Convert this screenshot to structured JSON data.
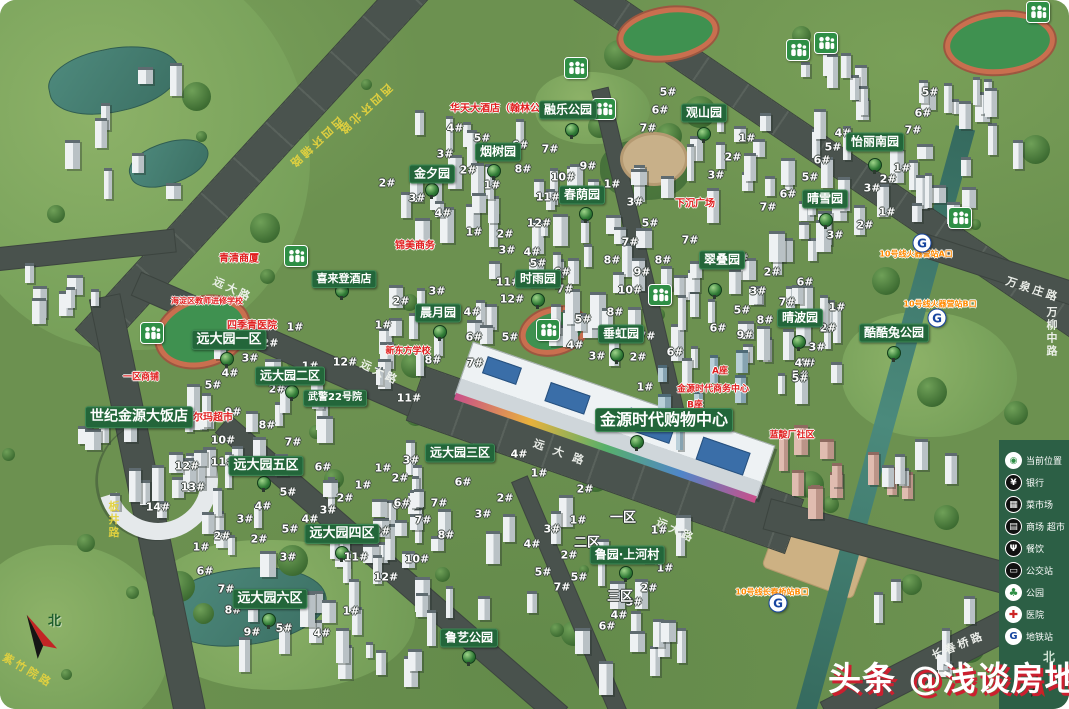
{
  "watermark": {
    "text": "头条 @浅谈房地产"
  },
  "compass": {
    "north": "北"
  },
  "legend": {
    "north": "北",
    "panel_color": "#2c5f45",
    "items": [
      {
        "label": "当前位置",
        "icon": "loc",
        "glyph": "◉"
      },
      {
        "label": "银行",
        "icon": "bank",
        "glyph": "¥"
      },
      {
        "label": "菜市场",
        "icon": "market",
        "glyph": "▦"
      },
      {
        "label": "商场 超市",
        "icon": "mall",
        "glyph": "▤"
      },
      {
        "label": "餐饮",
        "icon": "food",
        "glyph": "Ψ"
      },
      {
        "label": "公交站",
        "icon": "bus",
        "glyph": "▭"
      },
      {
        "label": "公园",
        "icon": "park",
        "glyph": "♣"
      },
      {
        "label": "医院",
        "icon": "hospital",
        "glyph": "✚"
      },
      {
        "label": "地铁站",
        "icon": "subway",
        "glyph": "G"
      }
    ]
  },
  "colors": {
    "label_green": "#23663a",
    "legend_green": "#2c5f45",
    "grass": "#6c9150",
    "road": "#49524d",
    "water": "#3f7a6e",
    "red_text": "#e01f1f",
    "orange_text": "#ff8a00"
  },
  "map": {
    "place_labels": [
      {
        "t": "融乐公园",
        "x": 568,
        "y": 110,
        "s": 12
      },
      {
        "t": "观山园",
        "x": 704,
        "y": 113,
        "s": 12
      },
      {
        "t": "怡丽南园",
        "x": 875,
        "y": 142,
        "s": 12
      },
      {
        "t": "烟树园",
        "x": 498,
        "y": 152,
        "s": 12
      },
      {
        "t": "金夕园",
        "x": 432,
        "y": 174,
        "s": 12
      },
      {
        "t": "春荫园",
        "x": 582,
        "y": 195,
        "s": 12
      },
      {
        "t": "晴雪园",
        "x": 825,
        "y": 199,
        "s": 12
      },
      {
        "t": "翠叠园",
        "x": 722,
        "y": 260,
        "s": 12
      },
      {
        "t": "喜来登酒店",
        "x": 344,
        "y": 279,
        "s": 11
      },
      {
        "t": "时雨园",
        "x": 538,
        "y": 279,
        "s": 12
      },
      {
        "t": "晨月园",
        "x": 438,
        "y": 313,
        "s": 12
      },
      {
        "t": "晴波园",
        "x": 800,
        "y": 318,
        "s": 12
      },
      {
        "t": "酷酷兔公园",
        "x": 894,
        "y": 333,
        "s": 12
      },
      {
        "t": "垂虹园",
        "x": 621,
        "y": 334,
        "s": 12
      },
      {
        "t": "远大园一区",
        "x": 229,
        "y": 340,
        "s": 13
      },
      {
        "t": "远大园二区",
        "x": 290,
        "y": 376,
        "s": 12
      },
      {
        "t": "武警22号院",
        "x": 335,
        "y": 398,
        "s": 10
      },
      {
        "t": "世纪金源大饭店",
        "x": 139,
        "y": 417,
        "s": 14
      },
      {
        "t": "金源时代购物中心",
        "x": 664,
        "y": 420,
        "s": 16
      },
      {
        "t": "远大园三区",
        "x": 460,
        "y": 453,
        "s": 12
      },
      {
        "t": "远大园五区",
        "x": 266,
        "y": 466,
        "s": 13
      },
      {
        "t": "远大园四区",
        "x": 342,
        "y": 534,
        "s": 13
      },
      {
        "t": "鲁园·上河村",
        "x": 627,
        "y": 555,
        "s": 12
      },
      {
        "t": "远大园六区",
        "x": 270,
        "y": 599,
        "s": 13
      },
      {
        "t": "鲁艺公园",
        "x": 469,
        "y": 638,
        "s": 12
      }
    ],
    "area_labels": [
      {
        "t": "一区",
        "x": 623,
        "y": 516
      },
      {
        "t": "二区",
        "x": 587,
        "y": 541
      },
      {
        "t": "三区",
        "x": 620,
        "y": 595
      }
    ],
    "red_labels": [
      {
        "t": "华天大酒店（翰林公馆）",
        "x": 505,
        "y": 107,
        "s": 10
      },
      {
        "t": "下沉广场",
        "x": 695,
        "y": 202,
        "s": 10
      },
      {
        "t": "锦美商务",
        "x": 415,
        "y": 244,
        "s": 10
      },
      {
        "t": "青清商厦",
        "x": 239,
        "y": 257,
        "s": 10
      },
      {
        "t": "海淀区教师进修学校",
        "x": 207,
        "y": 301,
        "s": 8
      },
      {
        "t": "四季青医院",
        "x": 252,
        "y": 324,
        "s": 10
      },
      {
        "t": "新东方学校",
        "x": 408,
        "y": 350,
        "s": 9
      },
      {
        "t": "一区商铺",
        "x": 141,
        "y": 376,
        "s": 9
      },
      {
        "t": "沃尔玛超市",
        "x": 208,
        "y": 416,
        "s": 10
      },
      {
        "t": "金源时代商务中心",
        "x": 713,
        "y": 388,
        "s": 9
      },
      {
        "t": "A座",
        "x": 720,
        "y": 370,
        "s": 9
      },
      {
        "t": "B座",
        "x": 695,
        "y": 404,
        "s": 9
      },
      {
        "t": "蓝靛厂社区",
        "x": 792,
        "y": 434,
        "s": 9
      }
    ],
    "subway_entrances": [
      {
        "t": "10号线火器营站A口",
        "x": 916,
        "y": 254
      },
      {
        "t": "10号线火器营站B口",
        "x": 940,
        "y": 304
      },
      {
        "t": "10号线长春桥站B口",
        "x": 772,
        "y": 592
      }
    ],
    "subway_logos": [
      {
        "x": 922,
        "y": 243
      },
      {
        "x": 937,
        "y": 318
      },
      {
        "x": 778,
        "y": 603
      }
    ],
    "road_labels": [
      {
        "t": "西四环北路",
        "x": 365,
        "y": 110,
        "r": 137,
        "c": "#e3d23f"
      },
      {
        "t": "西四环辅路",
        "x": 316,
        "y": 143,
        "r": 137,
        "c": "#e3d23f"
      },
      {
        "t": "远大路",
        "x": 233,
        "y": 289,
        "r": 25,
        "c": "#f2f5f0"
      },
      {
        "t": "远大路",
        "x": 380,
        "y": 372,
        "r": 26,
        "c": "#f2f5f0"
      },
      {
        "t": "远 大 路",
        "x": 560,
        "y": 452,
        "r": 20,
        "c": "#f2f5f0"
      },
      {
        "t": "远大路",
        "x": 676,
        "y": 530,
        "r": 25,
        "c": "#f2f5f0"
      },
      {
        "t": "板井路",
        "x": 113,
        "y": 520,
        "r": 0,
        "c": "#e3d23f",
        "v": true
      },
      {
        "t": "紫竹院路",
        "x": 28,
        "y": 670,
        "r": 30,
        "c": "#e3d23f"
      },
      {
        "t": "长春桥路",
        "x": 958,
        "y": 645,
        "r": -22,
        "c": "#f2f5f0"
      },
      {
        "t": "万泉庄路",
        "x": 1033,
        "y": 289,
        "r": 18,
        "c": "#f2f5f0"
      },
      {
        "t": "万柳中路",
        "x": 1051,
        "y": 332,
        "r": 0,
        "c": "#f2f5f0",
        "v": true
      }
    ],
    "people_icons": [
      {
        "x": 576,
        "y": 68
      },
      {
        "x": 604,
        "y": 109
      },
      {
        "x": 798,
        "y": 50
      },
      {
        "x": 826,
        "y": 43
      },
      {
        "x": 1038,
        "y": 12
      },
      {
        "x": 960,
        "y": 218
      },
      {
        "x": 296,
        "y": 256
      },
      {
        "x": 152,
        "y": 333
      },
      {
        "x": 548,
        "y": 330
      },
      {
        "x": 660,
        "y": 295
      }
    ],
    "tree_markers": [
      {
        "x": 432,
        "y": 190
      },
      {
        "x": 494,
        "y": 171
      },
      {
        "x": 586,
        "y": 214
      },
      {
        "x": 572,
        "y": 130
      },
      {
        "x": 704,
        "y": 134
      },
      {
        "x": 875,
        "y": 165
      },
      {
        "x": 826,
        "y": 220
      },
      {
        "x": 715,
        "y": 290
      },
      {
        "x": 799,
        "y": 342
      },
      {
        "x": 894,
        "y": 353
      },
      {
        "x": 538,
        "y": 300
      },
      {
        "x": 440,
        "y": 332
      },
      {
        "x": 617,
        "y": 355
      },
      {
        "x": 227,
        "y": 359
      },
      {
        "x": 292,
        "y": 392
      },
      {
        "x": 264,
        "y": 483
      },
      {
        "x": 342,
        "y": 553
      },
      {
        "x": 269,
        "y": 620
      },
      {
        "x": 626,
        "y": 573
      },
      {
        "x": 469,
        "y": 657
      },
      {
        "x": 342,
        "y": 291
      },
      {
        "x": 637,
        "y": 442
      }
    ],
    "unit_labels": [
      {
        "t": "5#",
        "x": 668,
        "y": 92
      },
      {
        "t": "6#",
        "x": 660,
        "y": 110
      },
      {
        "t": "7#",
        "x": 648,
        "y": 128
      },
      {
        "t": "1#",
        "x": 747,
        "y": 138
      },
      {
        "t": "2#",
        "x": 733,
        "y": 157
      },
      {
        "t": "3#",
        "x": 716,
        "y": 175
      },
      {
        "t": "5#",
        "x": 930,
        "y": 92
      },
      {
        "t": "6#",
        "x": 923,
        "y": 113
      },
      {
        "t": "7#",
        "x": 913,
        "y": 130
      },
      {
        "t": "4#",
        "x": 843,
        "y": 133
      },
      {
        "t": "5#",
        "x": 833,
        "y": 147
      },
      {
        "t": "6#",
        "x": 822,
        "y": 160
      },
      {
        "t": "1#",
        "x": 902,
        "y": 168
      },
      {
        "t": "2#",
        "x": 888,
        "y": 179
      },
      {
        "t": "3#",
        "x": 872,
        "y": 188
      },
      {
        "t": "5#",
        "x": 810,
        "y": 177
      },
      {
        "t": "6#",
        "x": 788,
        "y": 194
      },
      {
        "t": "7#",
        "x": 768,
        "y": 207
      },
      {
        "t": "1#",
        "x": 887,
        "y": 212
      },
      {
        "t": "2#",
        "x": 865,
        "y": 225
      },
      {
        "t": "3#",
        "x": 835,
        "y": 235
      },
      {
        "t": "4#",
        "x": 455,
        "y": 128
      },
      {
        "t": "5#",
        "x": 482,
        "y": 138
      },
      {
        "t": "3#",
        "x": 445,
        "y": 154
      },
      {
        "t": "6#",
        "x": 520,
        "y": 145
      },
      {
        "t": "7#",
        "x": 550,
        "y": 149
      },
      {
        "t": "2#",
        "x": 468,
        "y": 170
      },
      {
        "t": "1#",
        "x": 492,
        "y": 185
      },
      {
        "t": "8#",
        "x": 523,
        "y": 169
      },
      {
        "t": "9#",
        "x": 588,
        "y": 166
      },
      {
        "t": "10#",
        "x": 563,
        "y": 177
      },
      {
        "t": "11#",
        "x": 548,
        "y": 197
      },
      {
        "t": "12#",
        "x": 539,
        "y": 223
      },
      {
        "t": "1#",
        "x": 612,
        "y": 184
      },
      {
        "t": "3#",
        "x": 635,
        "y": 202
      },
      {
        "t": "5#",
        "x": 650,
        "y": 223
      },
      {
        "t": "2#",
        "x": 387,
        "y": 183
      },
      {
        "t": "3#",
        "x": 417,
        "y": 198
      },
      {
        "t": "4#",
        "x": 443,
        "y": 213
      },
      {
        "t": "1#",
        "x": 474,
        "y": 232
      },
      {
        "t": "2#",
        "x": 505,
        "y": 234
      },
      {
        "t": "7#",
        "x": 690,
        "y": 240
      },
      {
        "t": "8#",
        "x": 663,
        "y": 260
      },
      {
        "t": "1#",
        "x": 740,
        "y": 258
      },
      {
        "t": "2#",
        "x": 772,
        "y": 272
      },
      {
        "t": "3#",
        "x": 758,
        "y": 291
      },
      {
        "t": "5#",
        "x": 742,
        "y": 310
      },
      {
        "t": "6#",
        "x": 718,
        "y": 328
      },
      {
        "t": "9#",
        "x": 745,
        "y": 335
      },
      {
        "t": "6#",
        "x": 805,
        "y": 282
      },
      {
        "t": "7#",
        "x": 787,
        "y": 302
      },
      {
        "t": "8#",
        "x": 765,
        "y": 320
      },
      {
        "t": "1#",
        "x": 837,
        "y": 307
      },
      {
        "t": "2#",
        "x": 828,
        "y": 328
      },
      {
        "t": "3#",
        "x": 817,
        "y": 347
      },
      {
        "t": "4#",
        "x": 807,
        "y": 363
      },
      {
        "t": "5#",
        "x": 800,
        "y": 375
      },
      {
        "t": "3#",
        "x": 507,
        "y": 250
      },
      {
        "t": "4#",
        "x": 532,
        "y": 252
      },
      {
        "t": "5#",
        "x": 538,
        "y": 263
      },
      {
        "t": "6#",
        "x": 562,
        "y": 272
      },
      {
        "t": "7#",
        "x": 565,
        "y": 289
      },
      {
        "t": "11#",
        "x": 508,
        "y": 282
      },
      {
        "t": "12#",
        "x": 512,
        "y": 299
      },
      {
        "t": "7#",
        "x": 630,
        "y": 242
      },
      {
        "t": "8#",
        "x": 612,
        "y": 260
      },
      {
        "t": "9#",
        "x": 642,
        "y": 272
      },
      {
        "t": "10#",
        "x": 630,
        "y": 290
      },
      {
        "t": "8#",
        "x": 615,
        "y": 312
      },
      {
        "t": "5#",
        "x": 583,
        "y": 319
      },
      {
        "t": "4#",
        "x": 575,
        "y": 345
      },
      {
        "t": "3#",
        "x": 597,
        "y": 356
      },
      {
        "t": "2#",
        "x": 638,
        "y": 357
      },
      {
        "t": "7#",
        "x": 647,
        "y": 336
      },
      {
        "t": "1#",
        "x": 645,
        "y": 387
      },
      {
        "t": "2#",
        "x": 401,
        "y": 301
      },
      {
        "t": "3#",
        "x": 437,
        "y": 291
      },
      {
        "t": "1#",
        "x": 383,
        "y": 325
      },
      {
        "t": "4#",
        "x": 472,
        "y": 312
      },
      {
        "t": "6#",
        "x": 474,
        "y": 337
      },
      {
        "t": "5#",
        "x": 510,
        "y": 337
      },
      {
        "t": "8#",
        "x": 433,
        "y": 360
      },
      {
        "t": "7#",
        "x": 475,
        "y": 363
      },
      {
        "t": "11#",
        "x": 409,
        "y": 398
      },
      {
        "t": "12#",
        "x": 345,
        "y": 362
      },
      {
        "t": "1#",
        "x": 295,
        "y": 327
      },
      {
        "t": "2#",
        "x": 270,
        "y": 343
      },
      {
        "t": "3#",
        "x": 250,
        "y": 358
      },
      {
        "t": "4#",
        "x": 230,
        "y": 373
      },
      {
        "t": "5#",
        "x": 213,
        "y": 385
      },
      {
        "t": "1#",
        "x": 310,
        "y": 366
      },
      {
        "t": "2#",
        "x": 277,
        "y": 389
      },
      {
        "t": "9#",
        "x": 233,
        "y": 412
      },
      {
        "t": "8#",
        "x": 267,
        "y": 425
      },
      {
        "t": "6#",
        "x": 675,
        "y": 352
      },
      {
        "t": "4#",
        "x": 519,
        "y": 454
      },
      {
        "t": "1#",
        "x": 539,
        "y": 473
      },
      {
        "t": "4#",
        "x": 803,
        "y": 363
      },
      {
        "t": "5#",
        "x": 800,
        "y": 378
      },
      {
        "t": "10#",
        "x": 223,
        "y": 440
      },
      {
        "t": "11#",
        "x": 223,
        "y": 462
      },
      {
        "t": "12#",
        "x": 187,
        "y": 466
      },
      {
        "t": "13#",
        "x": 193,
        "y": 487
      },
      {
        "t": "14#",
        "x": 158,
        "y": 507
      },
      {
        "t": "7#",
        "x": 293,
        "y": 442
      },
      {
        "t": "6#",
        "x": 323,
        "y": 467
      },
      {
        "t": "5#",
        "x": 288,
        "y": 492
      },
      {
        "t": "4#",
        "x": 263,
        "y": 506
      },
      {
        "t": "3#",
        "x": 245,
        "y": 519
      },
      {
        "t": "2#",
        "x": 222,
        "y": 536
      },
      {
        "t": "1#",
        "x": 201,
        "y": 547
      },
      {
        "t": "2#",
        "x": 259,
        "y": 539
      },
      {
        "t": "3#",
        "x": 288,
        "y": 557
      },
      {
        "t": "6#",
        "x": 205,
        "y": 571
      },
      {
        "t": "7#",
        "x": 226,
        "y": 589
      },
      {
        "t": "8#",
        "x": 233,
        "y": 610
      },
      {
        "t": "9#",
        "x": 252,
        "y": 632
      },
      {
        "t": "5#",
        "x": 284,
        "y": 628
      },
      {
        "t": "4#",
        "x": 322,
        "y": 633
      },
      {
        "t": "1#",
        "x": 351,
        "y": 611
      },
      {
        "t": "9#",
        "x": 382,
        "y": 531
      },
      {
        "t": "10#",
        "x": 417,
        "y": 559
      },
      {
        "t": "11#",
        "x": 356,
        "y": 557
      },
      {
        "t": "12#",
        "x": 386,
        "y": 577
      },
      {
        "t": "1#",
        "x": 383,
        "y": 468
      },
      {
        "t": "2#",
        "x": 400,
        "y": 478
      },
      {
        "t": "3#",
        "x": 411,
        "y": 460
      },
      {
        "t": "1#",
        "x": 363,
        "y": 485
      },
      {
        "t": "2#",
        "x": 345,
        "y": 498
      },
      {
        "t": "3#",
        "x": 328,
        "y": 510
      },
      {
        "t": "4#",
        "x": 310,
        "y": 519
      },
      {
        "t": "5#",
        "x": 290,
        "y": 529
      },
      {
        "t": "6#",
        "x": 401,
        "y": 505
      },
      {
        "t": "6#",
        "x": 463,
        "y": 482
      },
      {
        "t": "2#",
        "x": 505,
        "y": 498
      },
      {
        "t": "6#",
        "x": 402,
        "y": 503
      },
      {
        "t": "7#",
        "x": 439,
        "y": 503
      },
      {
        "t": "3#",
        "x": 483,
        "y": 514
      },
      {
        "t": "7#",
        "x": 423,
        "y": 520
      },
      {
        "t": "8#",
        "x": 446,
        "y": 535
      },
      {
        "t": "2#",
        "x": 585,
        "y": 489
      },
      {
        "t": "1#",
        "x": 578,
        "y": 520
      },
      {
        "t": "3#",
        "x": 552,
        "y": 529
      },
      {
        "t": "4#",
        "x": 532,
        "y": 544
      },
      {
        "t": "2#",
        "x": 569,
        "y": 555
      },
      {
        "t": "5#",
        "x": 543,
        "y": 572
      },
      {
        "t": "5#",
        "x": 579,
        "y": 577
      },
      {
        "t": "7#",
        "x": 562,
        "y": 587
      },
      {
        "t": "1#",
        "x": 659,
        "y": 530
      },
      {
        "t": "1#",
        "x": 665,
        "y": 568
      },
      {
        "t": "2#",
        "x": 649,
        "y": 588
      },
      {
        "t": "3#",
        "x": 634,
        "y": 602
      },
      {
        "t": "4#",
        "x": 619,
        "y": 615
      },
      {
        "t": "6#",
        "x": 607,
        "y": 626
      }
    ]
  }
}
